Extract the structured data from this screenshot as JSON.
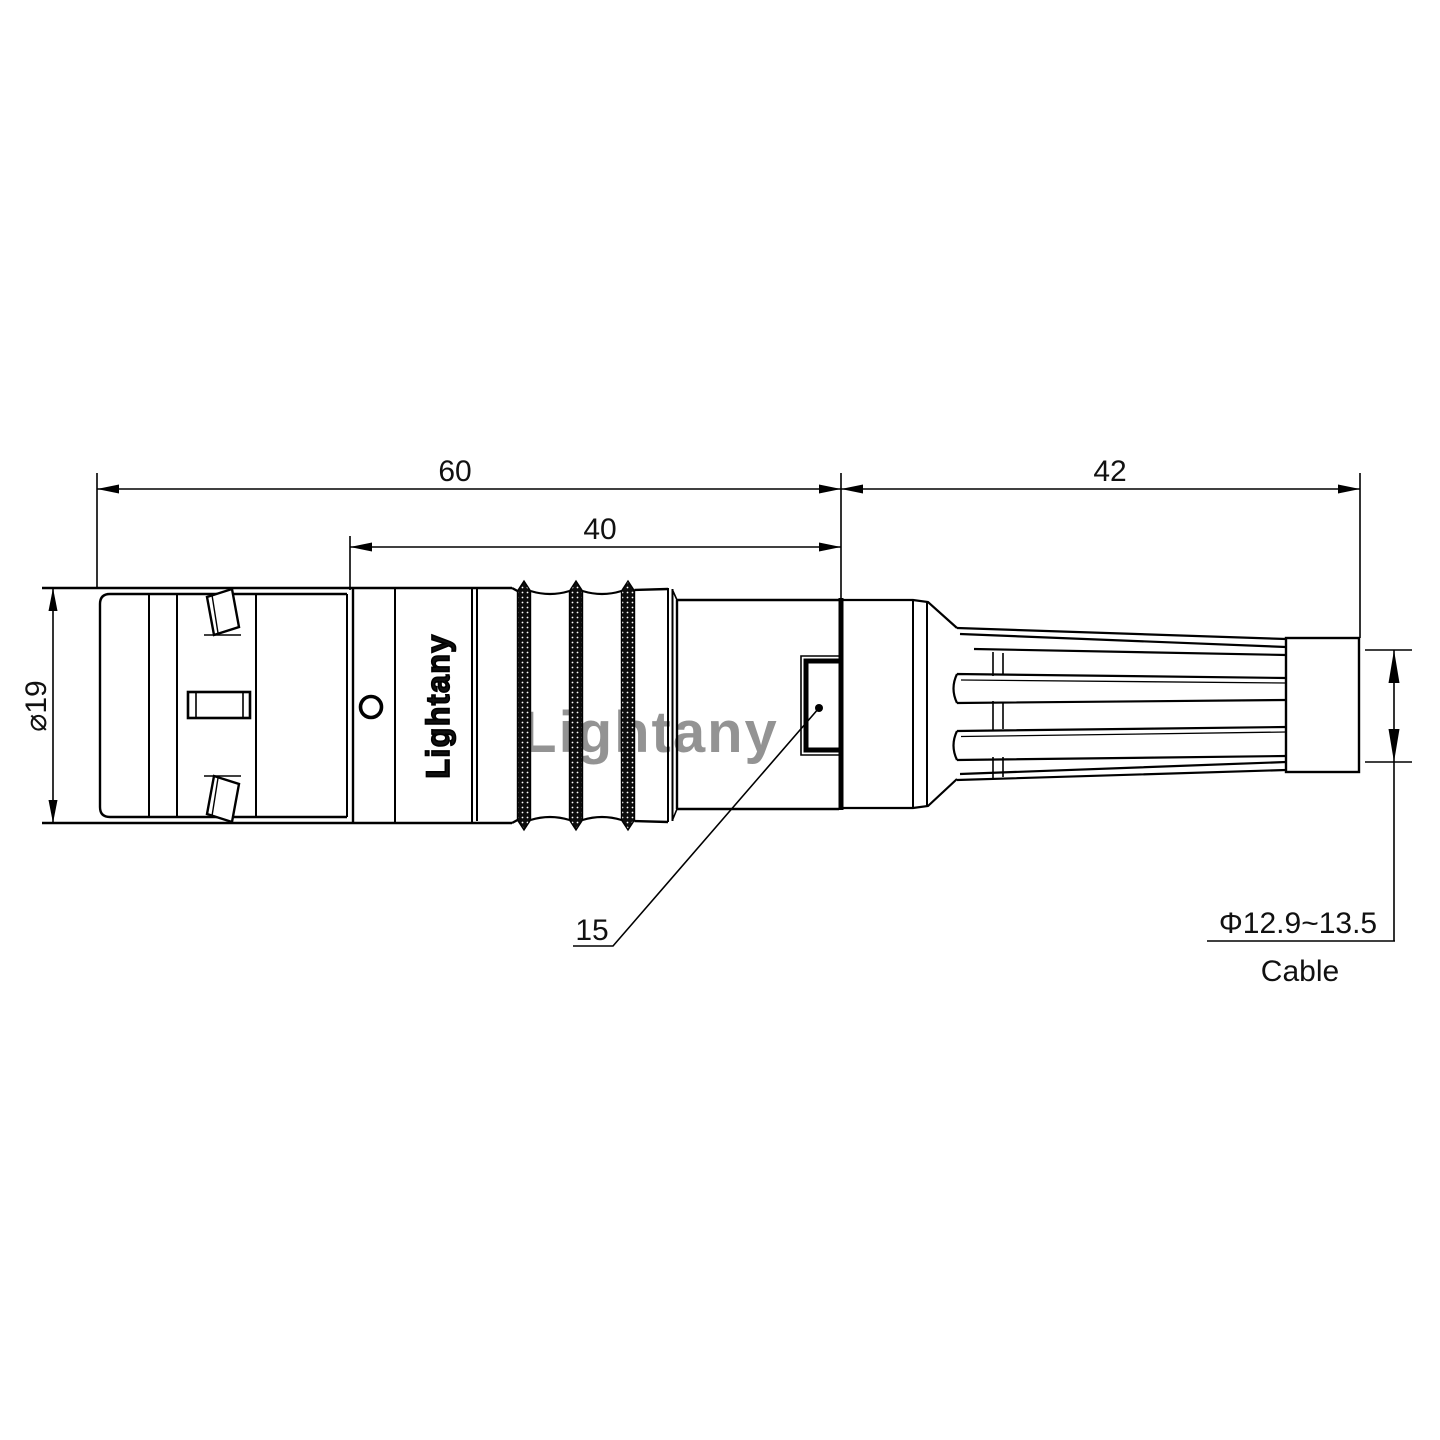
{
  "drawing": {
    "type": "connector-outline-dimension-drawing",
    "dimensions": {
      "front_length": "60",
      "mid_length": "40",
      "boot_length": "42",
      "shell_diameter": "⌀19",
      "latch_ref": "15",
      "cable_range": "Φ12.9~13.5",
      "cable_caption": "Cable"
    },
    "branding": {
      "shell_marking": "Lightany",
      "watermark": "Lightany"
    },
    "colors": {
      "line": "#000000",
      "watermark": "#dd8888"
    }
  }
}
